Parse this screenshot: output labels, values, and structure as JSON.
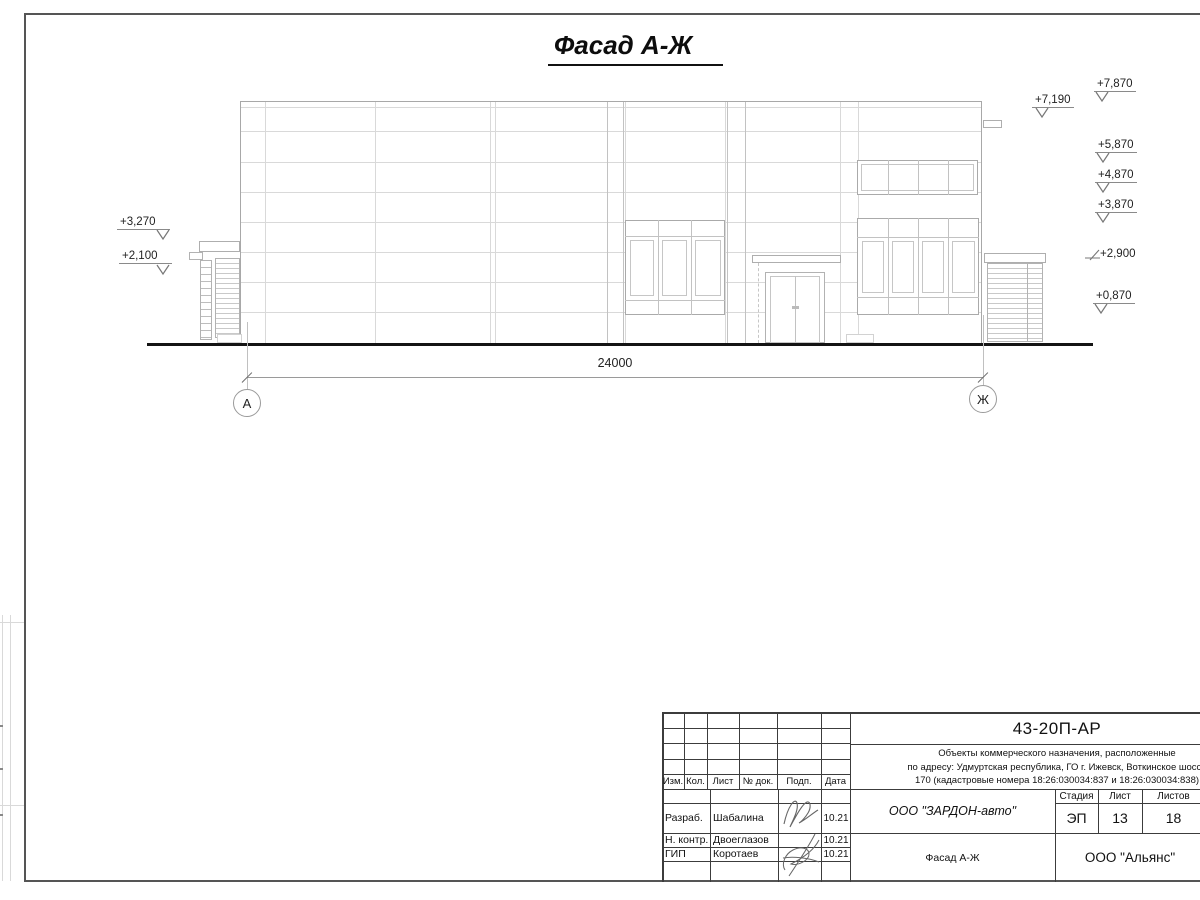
{
  "page_title": "Фасад А-Ж",
  "drawing": {
    "dimension_total": "24000",
    "axis_left": "А",
    "axis_right": "Ж",
    "elev_left": [
      "+3,270",
      "+2,100"
    ],
    "elev_right": [
      "+7,870",
      "+5,870",
      "+4,870",
      "+3,870",
      "+2,900",
      "+0,870"
    ],
    "elev_canopy": "+7,190"
  },
  "titleblock": {
    "doc_number": "43-20П-АР",
    "address_lines": [
      "Объекты коммерческого назначения, расположенные",
      "по адресу: Удмуртская республика, ГО г. Ижевск, Воткинское шоссе",
      "170 (кадастровые номера 18:26:030034:837 и 18:26:030034:838)"
    ],
    "header_cols": [
      "Изм.",
      "Кол.",
      "Лист",
      "№ док.",
      "Подп.",
      "Дата"
    ],
    "rows": [
      {
        "role": "Разраб.",
        "name": "Шабалина",
        "date": "10.21"
      },
      {
        "role": "Н. контр.",
        "name": "Двоеглазов",
        "date": "10.21"
      },
      {
        "role": "ГИП",
        "name": "Коротаев",
        "date": "10.21"
      }
    ],
    "customer": "ООО \"ЗАРДОН-авто\"",
    "stage_label": "Стадия",
    "sheet_label": "Лист",
    "sheets_label": "Листов",
    "stage": "ЭП",
    "sheet_no": "13",
    "sheets_total": "18",
    "sheet_name": "Фасад А-Ж",
    "org": "ООО \"Альянс\"",
    "colors": {
      "building_line": "#c6c6c6",
      "frame_line": "#555555",
      "ground_line": "#141414"
    }
  }
}
